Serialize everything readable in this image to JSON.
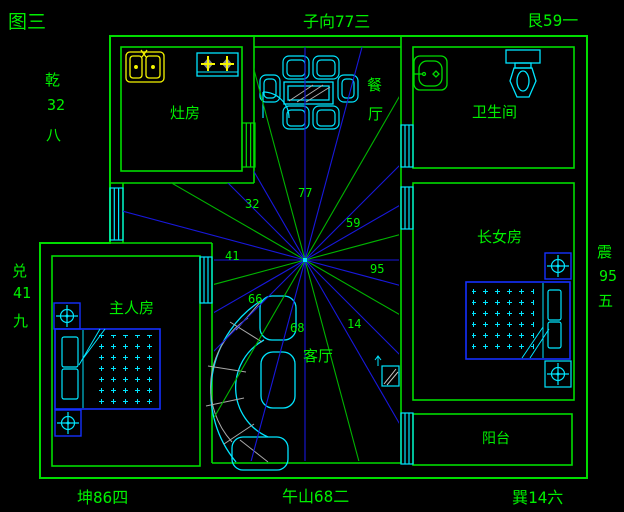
{
  "title": "图三",
  "palette": {
    "background": "#000000",
    "wall_green": "#00dc00",
    "text_green": "#00f000",
    "fixture_cyan": "#00e5ff",
    "fixture_yellow": "#f5f500",
    "furniture_blue": "#1430ff",
    "ray_blue": "#1818dc",
    "ray_green": "#00b400",
    "detail_gray": "#b0b0b0"
  },
  "compass": {
    "top_center": "子向77三",
    "top_right": "艮59一",
    "left_upper": [
      "乾",
      "32",
      "八"
    ],
    "left_lower": [
      "兑",
      "41",
      "九"
    ],
    "right": [
      "震",
      "95",
      "五"
    ],
    "bottom_left": "坤86四",
    "bottom_center": "午山68二",
    "bottom_right": "巽14六"
  },
  "rooms": {
    "kitchen": "灶房",
    "dining": [
      "餐",
      "厅"
    ],
    "bathroom": "卫生间",
    "daughter": "长女房",
    "master": "主人房",
    "living": "客厅",
    "balcony": "阳台"
  },
  "ray_numbers": [
    "77",
    "32",
    "59",
    "41",
    "95",
    "66",
    "68",
    "14"
  ]
}
